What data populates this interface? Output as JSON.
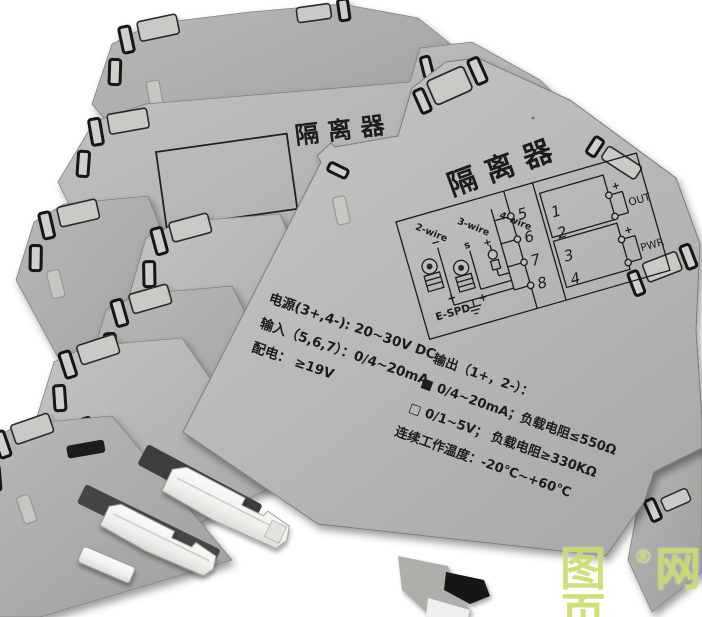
{
  "background_module": {
    "partial_title": "隔离器"
  },
  "front_module": {
    "title": "隔离器",
    "diagram": {
      "wire_labels": [
        "2-wire",
        "3-wire",
        "4-wire"
      ],
      "minus_label": "−",
      "s_label": "s",
      "plus_label": "+",
      "device_label": "E-SPD",
      "input_terminals": [
        "5",
        "6",
        "7",
        "8"
      ],
      "out_terminals": [
        "1",
        "2"
      ],
      "pwr_terminals": [
        "3",
        "4"
      ],
      "out_label": "OUT",
      "pwr_label": "PWR"
    },
    "specs_left": {
      "line1": "电源(3+,4-): 20~30V DC",
      "line2": "输入（5,6,7）：0/4~20mA",
      "line3": "配电： ≥19V"
    },
    "specs_right": {
      "line1": "输出（1+，2-）：",
      "line2": "■ 0/4~20mA；负载电阻≤550Ω",
      "line3": "□ 0/1~5V；  负载电阻≥330KΩ",
      "line4": "连续工作温度：-20℃~+60℃"
    }
  },
  "watermark": {
    "left": "图页",
    "reg": "®",
    "right": "网"
  },
  "colors": {
    "module_gray": "#b4b4b2",
    "print_ink": "#1b1b1b",
    "watermark_green": "#c9de70",
    "latch_white": "#f2f2f0"
  }
}
